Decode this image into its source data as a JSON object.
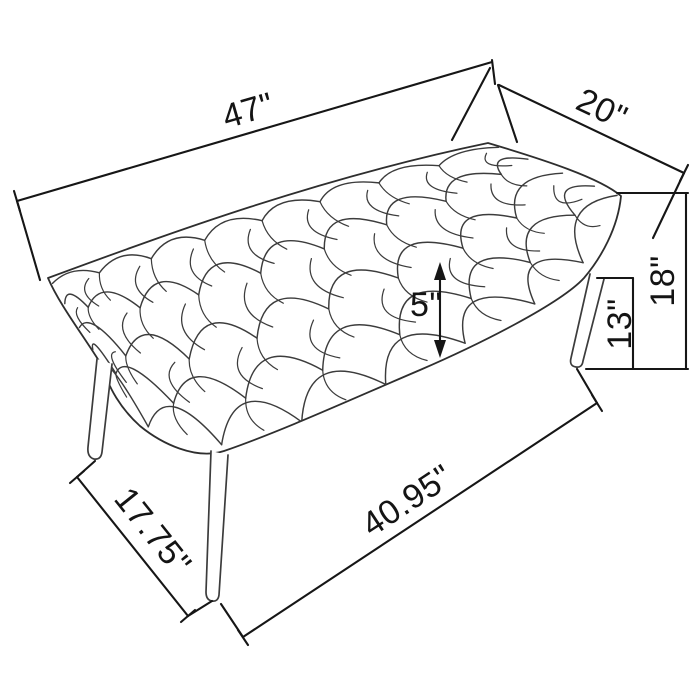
{
  "page": {
    "background": "#ffffff"
  },
  "drawing": {
    "subject": "button-tufted upholstered bench with splayed legs",
    "style": "technical line drawing with dimension annotations",
    "unit": "inches",
    "line_color": "#161616",
    "sketch_color": "#3c3c3c"
  },
  "dimensions": {
    "length": "47\"",
    "depth": "20\"",
    "overall_height": "18\"",
    "leg_height": "13\"",
    "seat_thickness": "5\"",
    "foot_depth_span": "17.75\"",
    "foot_length_span": "40.95\""
  }
}
